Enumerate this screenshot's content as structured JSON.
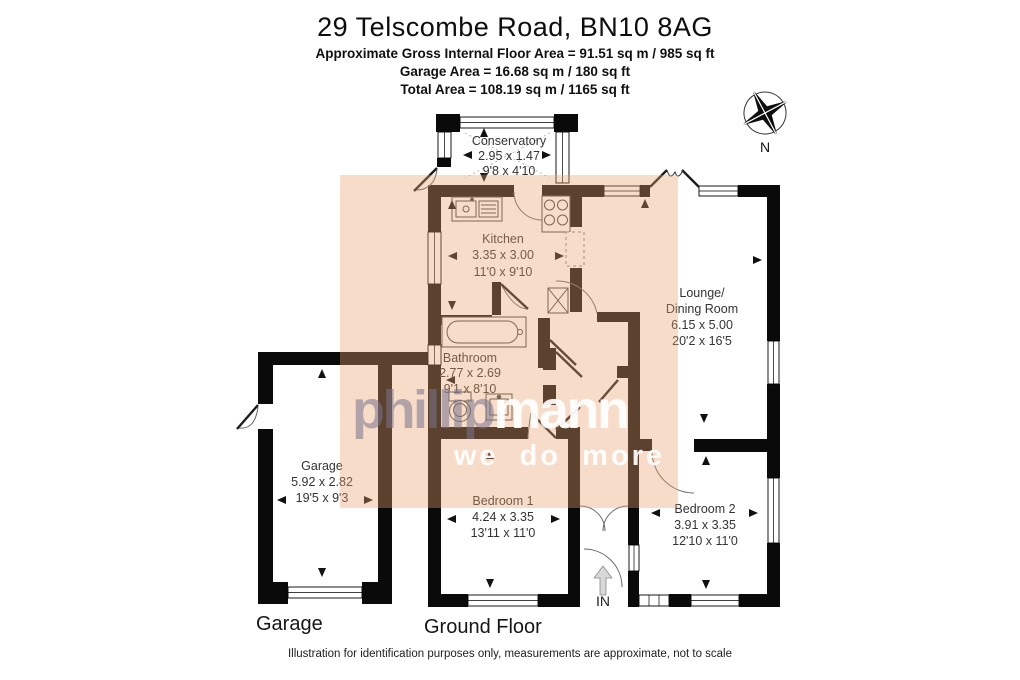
{
  "header": {
    "title": "29 Telscombe Road, BN10 8AG",
    "area_line": "Approximate Gross Internal Floor Area = 91.51 sq m / 985 sq ft",
    "garage_line": "Garage Area = 16.68 sq m / 180 sq ft",
    "total_line": "Total Area = 108.19 sq m / 1165 sq ft"
  },
  "compass": {
    "north_label": "N"
  },
  "watermark": {
    "name_light": "phillip",
    "name_bold": "mann",
    "tagline": "we do more"
  },
  "rooms": {
    "conservatory": {
      "name": "Conservatory",
      "metric": "2.95 x 1.47",
      "imperial": "9'8 x 4'10"
    },
    "kitchen": {
      "name": "Kitchen",
      "metric": "3.35 x 3.00",
      "imperial": "11'0 x 9'10"
    },
    "lounge": {
      "name_line1": "Lounge/",
      "name_line2": "Dining Room",
      "metric": "6.15 x 5.00",
      "imperial": "20'2 x 16'5"
    },
    "bathroom": {
      "name": "Bathroom",
      "metric": "2.77 x 2.69",
      "imperial": "9'1 x 8'10"
    },
    "garage": {
      "name": "Garage",
      "metric": "5.92 x 2.82",
      "imperial": "19'5 x 9'3"
    },
    "bedroom1": {
      "name": "Bedroom 1",
      "metric": "4.24 x 3.35",
      "imperial": "13'11 x 11'0"
    },
    "bedroom2": {
      "name": "Bedroom 2",
      "metric": "3.91 x 3.35",
      "imperial": "12'10 x 11'0"
    }
  },
  "entrance": {
    "label": "IN"
  },
  "footer": {
    "garage_caption": "Garage",
    "floor_caption": "Ground Floor",
    "disclaimer": "Illustration for identification purposes only, measurements are approximate, not to scale"
  },
  "colors": {
    "wall": "#0a0a0a",
    "highlight_overlay": "#eda06e",
    "watermark_gray": "#76748a",
    "watermark_white": "#ffffff"
  }
}
